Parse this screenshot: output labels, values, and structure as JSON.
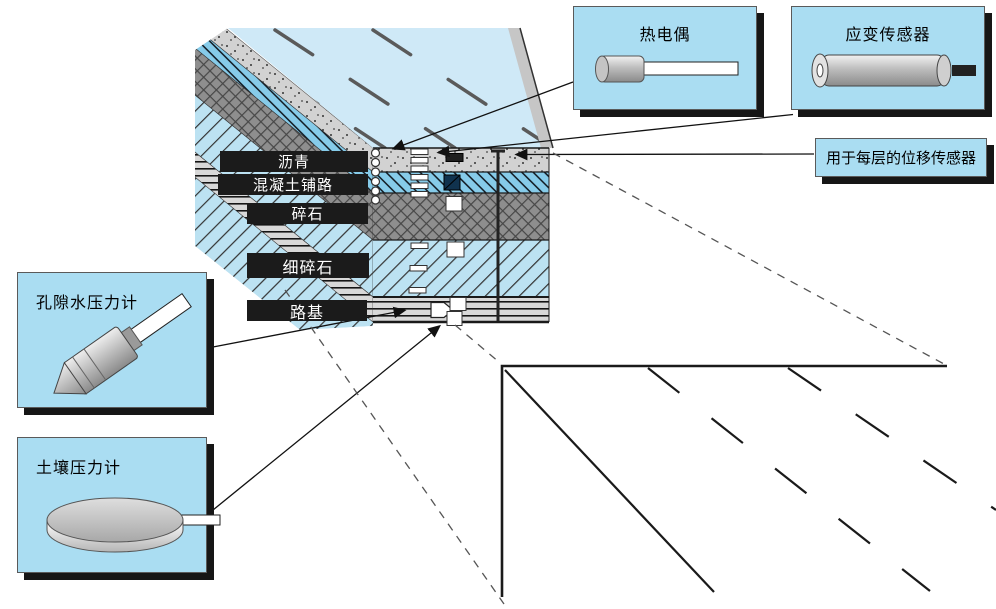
{
  "sensors": {
    "thermocouple": {
      "label": "热电偶",
      "icon": "thermocouple-probe-icon"
    },
    "strain": {
      "label": "应变传感器",
      "icon": "strain-gauge-icon"
    },
    "displacement": {
      "label": "用于每层的位移传感器",
      "icon": "none"
    },
    "pore_water": {
      "label": "孔隙水压力计",
      "icon": "pore-pressure-probe-icon"
    },
    "soil_pressure": {
      "label": "土壤压力计",
      "icon": "soil-pressure-disc-icon"
    }
  },
  "layers": {
    "asphalt": {
      "label": "沥青"
    },
    "concrete": {
      "label": "混凝土铺路"
    },
    "gravel": {
      "label": "碎石"
    },
    "fine_gravel": {
      "label": "细碎石"
    },
    "subgrade": {
      "label": "路基"
    }
  },
  "colors": {
    "callout_bg": "#aaddf2",
    "callout_shadow": "#161616",
    "layer_label_bg": "#1b1b1b",
    "layer_label_text": "#ffffff",
    "road_surface_blue": "#cfe9f7",
    "concrete_blue": "#86cbe9",
    "fine_gravel_blue": "#bce2f2",
    "asphalt_gray": "#d2d2d2",
    "gravel_gray": "#8e8e8e",
    "subgrade_gray": "#d8d8d8"
  }
}
